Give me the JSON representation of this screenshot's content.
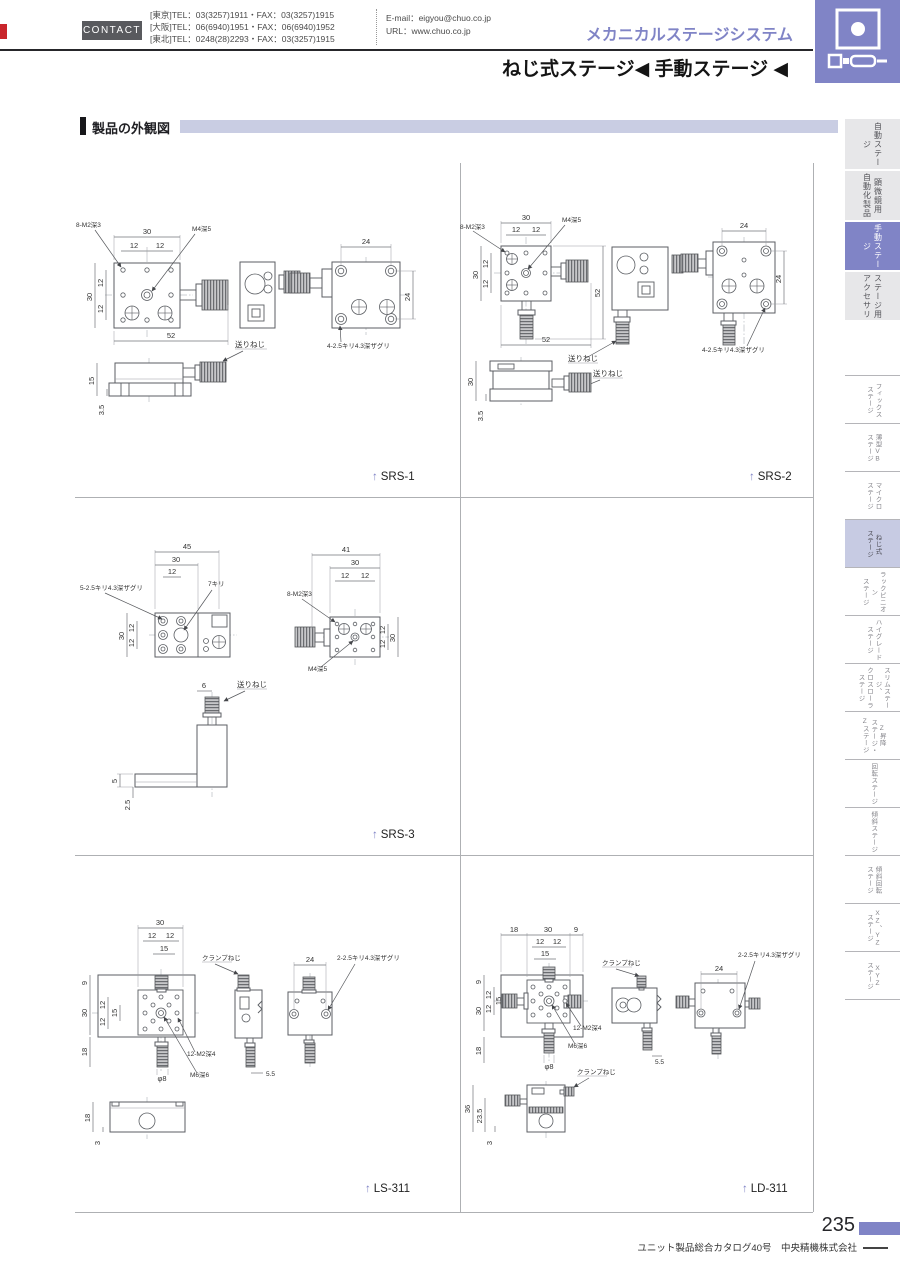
{
  "colors": {
    "accent": "#8084c6",
    "accent-light": "#c7cbe3",
    "section-bar": "#c9cde3",
    "tab-gray": "#e7e7e9",
    "line-gray": "#aeb0b3",
    "red-marker": "#c9252b"
  },
  "icons": {
    "up_arrow": "↑"
  },
  "header": {
    "contact": "CONTACT",
    "tel": [
      "[東京]TEL：03(3257)1911・FAX：03(3257)1915",
      "[大阪]TEL：06(6940)1951・FAX：06(6940)1952",
      "[東北]TEL：0248(28)2293・FAX：03(3257)1915"
    ],
    "email": "E-mail：eigyou@chuo.co.jp",
    "url": "URL：www.chuo.co.jp",
    "system_title": "メカニカルステージシステム",
    "page_title": "ねじ式ステージ◀ 手動ステージ ◀"
  },
  "section": {
    "title": "製品の外観図"
  },
  "sidebar": {
    "main_tabs": [
      {
        "lines": [
          "自動ステージ"
        ],
        "active": false
      },
      {
        "lines": [
          "顕微鏡用",
          "自動化製品"
        ],
        "active": false
      },
      {
        "lines": [
          "手動ステージ"
        ],
        "active": true
      },
      {
        "lines": [
          "ステージ用",
          "アクセサリ"
        ],
        "active": false
      }
    ],
    "sub_tabs": [
      {
        "lines": [
          "フィックス",
          "ステージ"
        ],
        "active": false
      },
      {
        "lines": [
          "薄型VB",
          "ステージ"
        ],
        "active": false
      },
      {
        "lines": [
          "マイクロ",
          "ステージ"
        ],
        "active": false
      },
      {
        "lines": [
          "ねじ式",
          "ステージ"
        ],
        "active": true
      },
      {
        "lines": [
          "ラックピニオン",
          "ステージ"
        ],
        "active": false
      },
      {
        "lines": [
          "ハイグレード",
          "ステージ"
        ],
        "active": false
      },
      {
        "lines": [
          "スリムステージ、",
          "クロスローラ",
          "ステージ"
        ],
        "active": false
      },
      {
        "lines": [
          "Z昇降",
          "ステージ・",
          "Zステージ"
        ],
        "active": false
      },
      {
        "lines": [
          "回転ステージ"
        ],
        "active": false
      },
      {
        "lines": [
          "傾斜ステージ"
        ],
        "active": false
      },
      {
        "lines": [
          "傾斜回転",
          "ステージ"
        ],
        "active": false
      },
      {
        "lines": [
          "XZ、YZ",
          "ステージ"
        ],
        "active": false
      },
      {
        "lines": [
          "XYZ",
          "ステージ"
        ],
        "active": false
      }
    ]
  },
  "drawings": {
    "srs1": {
      "name": "SRS-1",
      "d30": "30",
      "d12": "12",
      "d52": "52",
      "d24": "24",
      "d15": "15",
      "d3_5": "3.5",
      "tap8": "8-M2深3",
      "tap_c": "M4深5",
      "bore": "4-2.5キリ4.3深ザグリ",
      "feed": "送りねじ"
    },
    "srs2": {
      "name": "SRS-2",
      "d30": "30",
      "d12": "12",
      "d52": "52",
      "d24": "24",
      "d3_5": "3.5",
      "tap8": "8-M2深3",
      "tap_c": "M4深5",
      "bore": "4-2.5キリ4.3深ザグリ",
      "feed": "送りねじ"
    },
    "srs3": {
      "name": "SRS-3",
      "d45": "45",
      "d41": "41",
      "d30": "30",
      "d12": "12",
      "d6": "6",
      "d5": "5",
      "d2_5": "2.5",
      "bore5": "5-2.5キリ4.3深ザグリ",
      "kiri7": "7キリ",
      "tap8": "8-M2深3",
      "tap_c": "M4深5",
      "feed": "送りねじ"
    },
    "ls311": {
      "name": "LS-311",
      "d30": "30",
      "d12": "12",
      "d15": "15",
      "d9": "9",
      "d18": "18",
      "d24": "24",
      "d5_5": "5.5",
      "d3": "3",
      "phi8": "φ8",
      "tap12": "12-M2深4",
      "tap_m6": "M6深6",
      "bore2": "2-2.5キリ4.3深ザグリ",
      "clamp": "クランプねじ"
    },
    "ld311": {
      "name": "LD-311",
      "d18": "18",
      "d30": "30",
      "d9": "9",
      "d12": "12",
      "d15": "15",
      "d24": "24",
      "d5_5": "5.5",
      "d36": "36",
      "d23_5": "23.5",
      "d3": "3",
      "phi8": "φ8",
      "tap12": "12-M2深4",
      "tap_m6": "M6深6",
      "bore2": "2-2.5キリ4.3深ザグリ",
      "clamp": "クランプねじ"
    }
  },
  "footer": {
    "page": "235",
    "note": "ユニット製品総合カタログ40号　中央精機株式会社"
  }
}
